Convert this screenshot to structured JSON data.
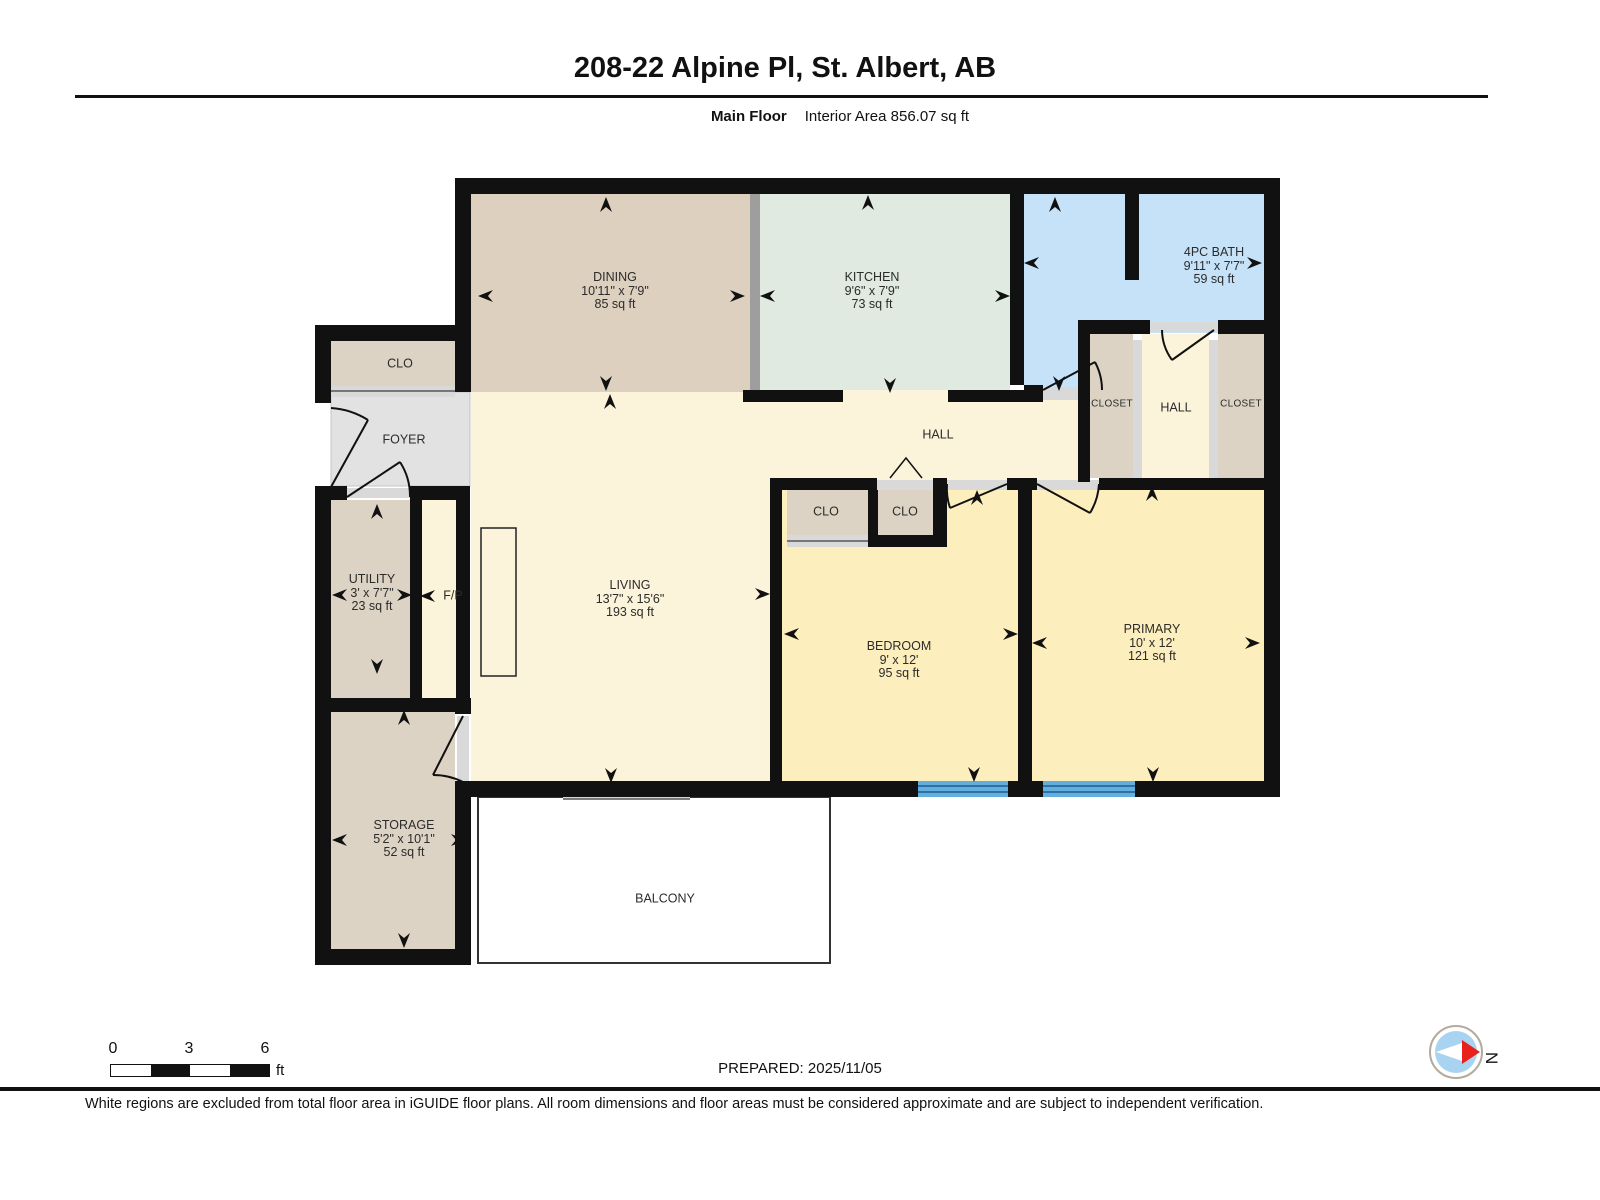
{
  "header": {
    "title": "208-22 Alpine Pl, St. Albert, AB",
    "floor_label": "Main Floor",
    "area_label": "Interior Area 856.07 sq ft"
  },
  "rooms": {
    "dining": {
      "name": "DINING",
      "dims": "10'11\" x 7'9\"",
      "area": "85 sq ft"
    },
    "kitchen": {
      "name": "KITCHEN",
      "dims": "9'6\" x 7'9\"",
      "area": "73 sq ft"
    },
    "bath": {
      "name": "4PC BATH",
      "dims": "9'11\" x 7'7\"",
      "area": "59 sq ft"
    },
    "clo_entry": {
      "name": "CLO"
    },
    "foyer": {
      "name": "FOYER"
    },
    "hall": {
      "name": "HALL"
    },
    "closet_left": {
      "name": "CLOSET"
    },
    "hall_right": {
      "name": "HALL"
    },
    "closet_right": {
      "name": "CLOSET"
    },
    "utility": {
      "name": "UTILITY",
      "dims": "3' x 7'7\"",
      "area": "23 sq ft"
    },
    "fireplace": {
      "name": "F/P"
    },
    "living": {
      "name": "LIVING",
      "dims": "13'7\" x 15'6\"",
      "area": "193 sq ft"
    },
    "clo_bed_left": {
      "name": "CLO"
    },
    "clo_bed_right": {
      "name": "CLO"
    },
    "bedroom": {
      "name": "BEDROOM",
      "dims": "9' x 12'",
      "area": "95 sq ft"
    },
    "primary": {
      "name": "PRIMARY",
      "dims": "10' x 12'",
      "area": "121 sq ft"
    },
    "storage": {
      "name": "STORAGE",
      "dims": "5'2\" x 10'1\"",
      "area": "52 sq ft"
    },
    "balcony": {
      "name": "BALCONY"
    }
  },
  "scale_bar": {
    "tick0": "0",
    "tick1": "3",
    "tick2": "6",
    "unit": "ft"
  },
  "footer": {
    "prepared": "PREPARED: 2025/11/05",
    "compass_label": "N",
    "disclaimer": "White regions are excluded from total floor area in iGUIDE floor plans. All room dimensions and floor areas must be considered approximate and are subject to independent verification."
  },
  "colors": {
    "wall": "#111111",
    "dining_fill": "#ddd0bf",
    "kitchen_fill": "#e0eae1",
    "bath_fill": "#c6e2f8",
    "hall_living_fill": "#fbf3da",
    "bedroom_fill": "#fdeebd",
    "foyer_fill": "#e2e2e2",
    "closet_fill": "#ddd3c4",
    "window_blue": "#64aede",
    "threshold_grey": "#d9d9d9",
    "compass_red": "#e8211d",
    "compass_blue": "#a9d4f1"
  }
}
